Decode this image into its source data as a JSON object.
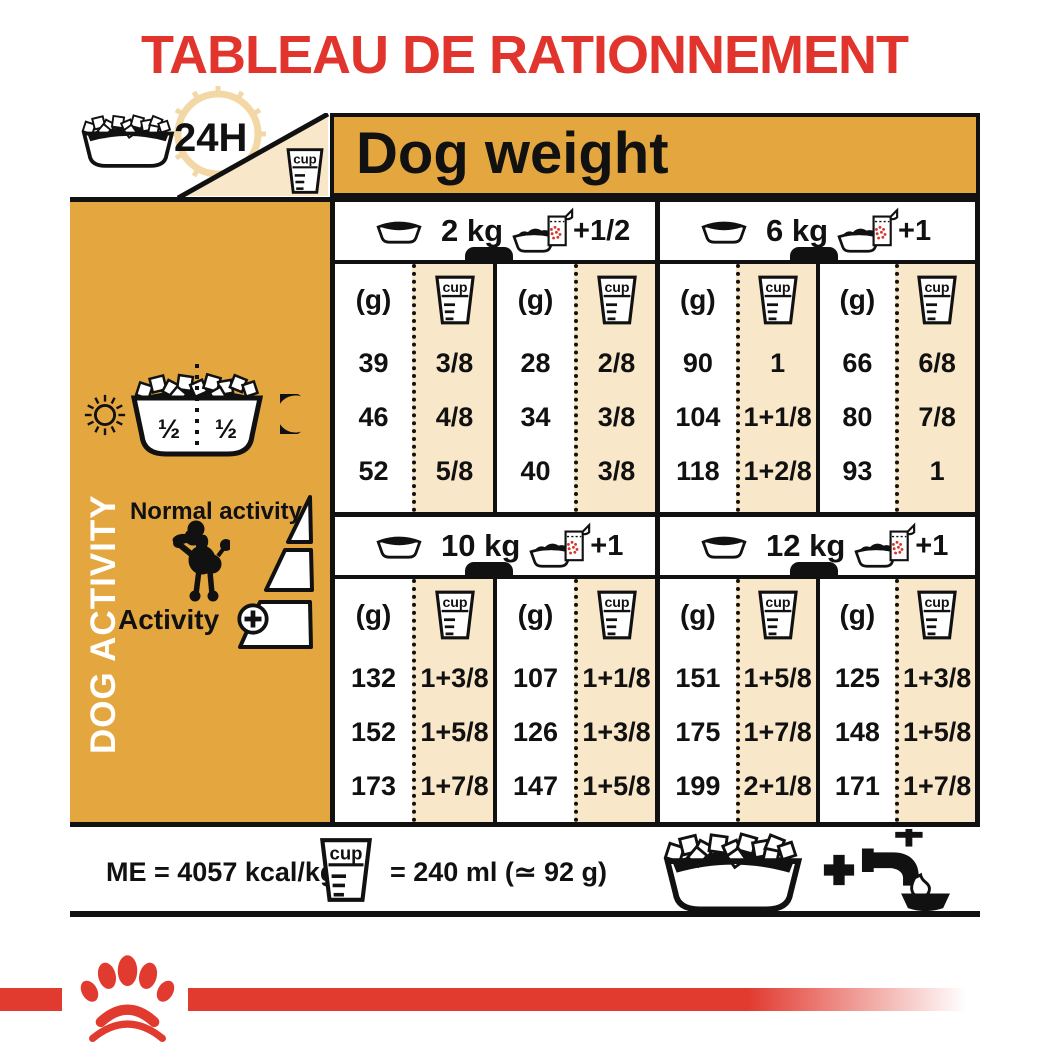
{
  "colors": {
    "accent_red": "#e0342c",
    "bar_red": "#e13b30",
    "orange": "#e4a73f",
    "cream": "#f8e7c9",
    "black": "#111111"
  },
  "title": "TABLEAU DE RATIONNEMENT",
  "header": {
    "duration_label": "24H",
    "dog_weight_label": "Dog weight"
  },
  "shared": {
    "cup_label": "cup",
    "unit_label": "(g)"
  },
  "sidebar": {
    "axis_label": "DOG ACTIVITY",
    "bowl_half_left": "½",
    "bowl_half_right": "½",
    "normal_activity_label": "Normal activity",
    "activity_label": "Activity"
  },
  "chart_data": {
    "type": "table",
    "title": "TABLEAU DE RATIONNEMENT",
    "column_axis_label": "Dog weight",
    "row_axis_label": "DOG ACTIVITY",
    "units": [
      "(g)",
      "cup"
    ],
    "blocks": [
      {
        "weight": "2 kg",
        "extra_ration": "+1/2",
        "halves": [
          {
            "rows": [
              {
                "g": "39",
                "cup": "3/8"
              },
              {
                "g": "46",
                "cup": "4/8"
              },
              {
                "g": "52",
                "cup": "5/8"
              }
            ]
          },
          {
            "rows": [
              {
                "g": "28",
                "cup": "2/8"
              },
              {
                "g": "34",
                "cup": "3/8"
              },
              {
                "g": "40",
                "cup": "3/8"
              }
            ]
          }
        ]
      },
      {
        "weight": "6 kg",
        "extra_ration": "+1",
        "halves": [
          {
            "rows": [
              {
                "g": "90",
                "cup": "1"
              },
              {
                "g": "104",
                "cup": "1+1/8"
              },
              {
                "g": "118",
                "cup": "1+2/8"
              }
            ]
          },
          {
            "rows": [
              {
                "g": "66",
                "cup": "6/8"
              },
              {
                "g": "80",
                "cup": "7/8"
              },
              {
                "g": "93",
                "cup": "1"
              }
            ]
          }
        ]
      },
      {
        "weight": "10 kg",
        "extra_ration": "+1",
        "halves": [
          {
            "rows": [
              {
                "g": "132",
                "cup": "1+3/8"
              },
              {
                "g": "152",
                "cup": "1+5/8"
              },
              {
                "g": "173",
                "cup": "1+7/8"
              }
            ]
          },
          {
            "rows": [
              {
                "g": "107",
                "cup": "1+1/8"
              },
              {
                "g": "126",
                "cup": "1+3/8"
              },
              {
                "g": "147",
                "cup": "1+5/8"
              }
            ]
          }
        ]
      },
      {
        "weight": "12 kg",
        "extra_ration": "+1",
        "halves": [
          {
            "rows": [
              {
                "g": "151",
                "cup": "1+5/8"
              },
              {
                "g": "175",
                "cup": "1+7/8"
              },
              {
                "g": "199",
                "cup": "2+1/8"
              }
            ]
          },
          {
            "rows": [
              {
                "g": "125",
                "cup": "1+3/8"
              },
              {
                "g": "148",
                "cup": "1+5/8"
              },
              {
                "g": "171",
                "cup": "1+7/8"
              }
            ]
          }
        ]
      }
    ]
  },
  "footer": {
    "me_label": "ME = 4057 kcal/kg",
    "cup_equivalence": "= 240 ml (≃ 92 g)"
  }
}
